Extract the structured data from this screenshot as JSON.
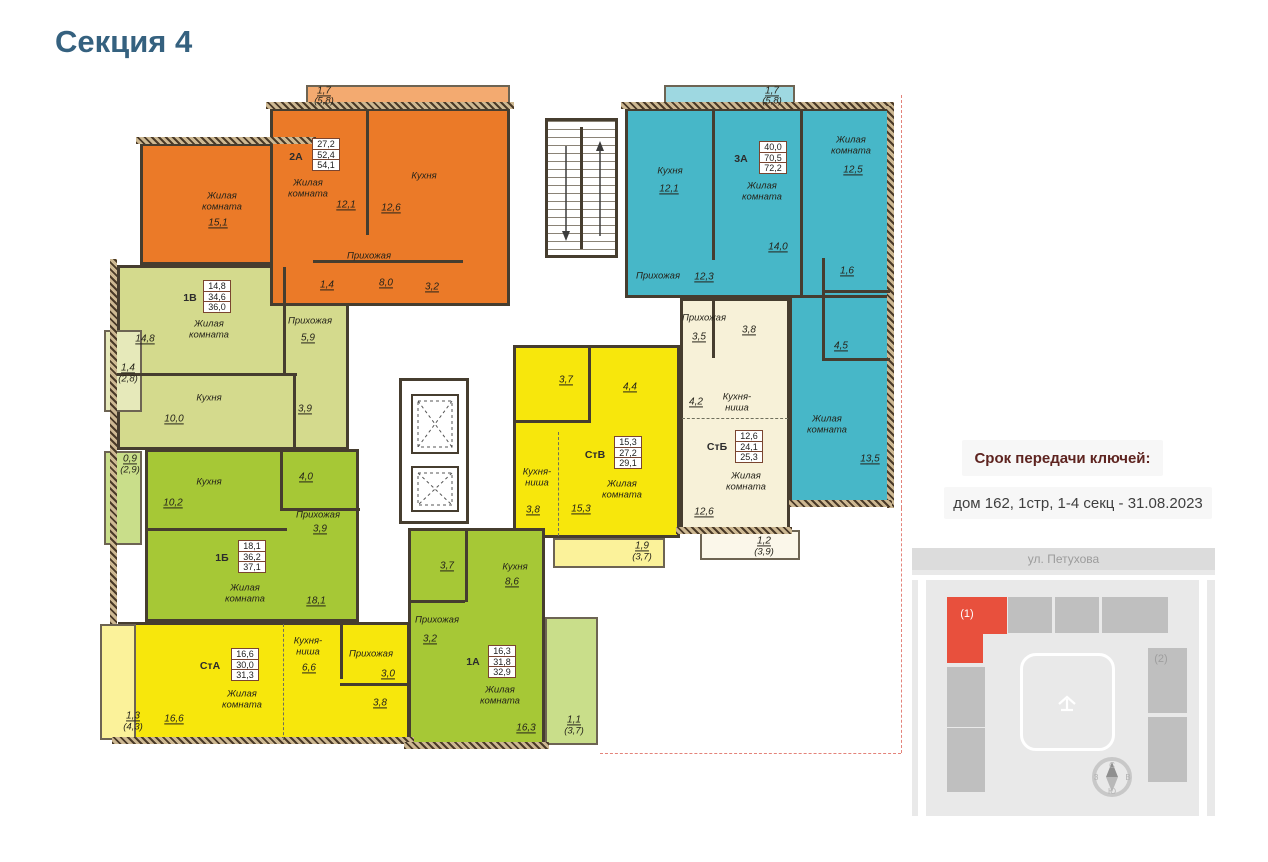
{
  "page": {
    "title": "Секция 4"
  },
  "sidebar": {
    "keys_title": "Срок передачи ключей:",
    "keys_info": "дом 162, 1стр, 1-4 секц - 31.08.2023"
  },
  "minimap": {
    "street": "ул. Петухова",
    "section1_label": "(1)",
    "section2_label": "(2)",
    "compass": {
      "n": "С",
      "e": "В",
      "s": "Ю",
      "w": "З"
    },
    "colors": {
      "highlight": "#e8503d",
      "block": "#bfbfbf",
      "card_bg": "#e9e9e9"
    }
  },
  "plan": {
    "colors": {
      "orange": "#eb7a28",
      "orange_light": "#f3aa70",
      "blue": "#47b7c8",
      "blue_light": "#9ed8e1",
      "green": "#a6c836",
      "green_light": "#c9de8a",
      "lightgreen": "#d4da8d",
      "lightgreen_light": "#e6e9ba",
      "yellow": "#f7e70c",
      "yellow_light": "#fbf29a",
      "cream": "#f7f1d8",
      "cream_light": "#fbf7ea",
      "wall": "#463d2f"
    },
    "apartments": [
      {
        "id": "1v",
        "label": "1В",
        "color": "lightgreen",
        "stats": [
          "14,8",
          "34,6",
          "36,0"
        ],
        "regions": [
          [
            117,
            265,
            232,
            185
          ]
        ],
        "label_xy": [
          190,
          298
        ],
        "table_xy": [
          203,
          281
        ],
        "balcony": {
          "rect": [
            104,
            330,
            38,
            82
          ],
          "color": "lightgreen_light"
        }
      },
      {
        "id": "1b",
        "label": "1Б",
        "color": "green",
        "stats": [
          "18,1",
          "36,2",
          "37,1"
        ],
        "regions": [
          [
            145,
            449,
            214,
            173
          ]
        ],
        "label_xy": [
          222,
          558
        ],
        "table_xy": [
          238,
          541
        ],
        "balcony": {
          "rect": [
            104,
            451,
            38,
            94
          ],
          "color": "green_light"
        }
      },
      {
        "id": "sta",
        "label": "СтА",
        "color": "yellow",
        "stats": [
          "16,6",
          "30,0",
          "31,3"
        ],
        "regions": [
          [
            118,
            622,
            292,
            120
          ]
        ],
        "label_xy": [
          210,
          666
        ],
        "table_xy": [
          231,
          649
        ],
        "balcony": {
          "rect": [
            100,
            624,
            36,
            116
          ],
          "color": "yellow_light"
        }
      },
      {
        "id": "2a",
        "label": "2А",
        "color": "orange",
        "stats": [
          "27,2",
          "52,4",
          "54,1"
        ],
        "regions": [
          [
            140,
            143,
            133,
            122
          ],
          [
            270,
            108,
            240,
            198
          ]
        ],
        "label_xy": [
          296,
          157
        ],
        "table_xy": [
          312,
          139
        ],
        "balcony": {
          "rect": [
            306,
            85,
            204,
            24
          ],
          "color": "orange_light"
        }
      },
      {
        "id": "3a",
        "label": "3А",
        "color": "blue",
        "stats": [
          "40,0",
          "70,5",
          "72,2"
        ],
        "regions": [
          [
            625,
            108,
            265,
            190
          ],
          [
            789,
            295,
            101,
            211
          ]
        ],
        "label_xy": [
          741,
          159
        ],
        "table_xy": [
          759,
          142
        ],
        "balcony": {
          "rect": [
            664,
            85,
            131,
            24
          ],
          "color": "blue_light"
        }
      },
      {
        "id": "stb",
        "label": "СтБ",
        "color": "cream",
        "stats": [
          "12,6",
          "24,1",
          "25,3"
        ],
        "regions": [
          [
            680,
            298,
            110,
            232
          ]
        ],
        "label_xy": [
          717,
          447
        ],
        "table_xy": [
          735,
          431
        ],
        "balcony": {
          "rect": [
            700,
            530,
            100,
            30
          ],
          "color": "cream_light"
        }
      },
      {
        "id": "stv",
        "label": "СтВ",
        "color": "yellow",
        "stats": [
          "15,3",
          "27,2",
          "29,1"
        ],
        "regions": [
          [
            513,
            345,
            167,
            193
          ]
        ],
        "label_xy": [
          595,
          455
        ],
        "table_xy": [
          614,
          437
        ],
        "balcony": {
          "rect": [
            553,
            538,
            112,
            30
          ],
          "color": "yellow_light"
        }
      },
      {
        "id": "1a",
        "label": "1А",
        "color": "green",
        "stats": [
          "16,3",
          "31,8",
          "32,9"
        ],
        "regions": [
          [
            408,
            528,
            137,
            217
          ]
        ],
        "label_xy": [
          473,
          662
        ],
        "table_xy": [
          488,
          646
        ],
        "balcony": {
          "rect": [
            545,
            617,
            53,
            128
          ],
          "color": "green_light"
        }
      }
    ],
    "texts": [
      {
        "t": "Жилая\nкомната",
        "x": 222,
        "y": 202,
        "k": "n"
      },
      {
        "t": "15,1",
        "x": 218,
        "y": 223,
        "k": "v"
      },
      {
        "t": "Жилая\nкомната",
        "x": 308,
        "y": 189,
        "k": "n"
      },
      {
        "t": "12,1",
        "x": 346,
        "y": 205,
        "k": "v"
      },
      {
        "t": "Кухня",
        "x": 424,
        "y": 177,
        "k": "n"
      },
      {
        "t": "12,6",
        "x": 391,
        "y": 208,
        "k": "v"
      },
      {
        "t": "Прихожая",
        "x": 369,
        "y": 257,
        "k": "n"
      },
      {
        "t": "8,0",
        "x": 386,
        "y": 283,
        "k": "v"
      },
      {
        "t": "1,4",
        "x": 327,
        "y": 285,
        "k": "v"
      },
      {
        "t": "3,2",
        "x": 432,
        "y": 287,
        "k": "v"
      },
      {
        "t": "1,7",
        "x": 324,
        "y": 91,
        "k": "v"
      },
      {
        "t": "(5,8)",
        "x": 324,
        "y": 102,
        "k": "b"
      },
      {
        "t": "Кухня",
        "x": 670,
        "y": 172,
        "k": "n"
      },
      {
        "t": "12,1",
        "x": 669,
        "y": 189,
        "k": "v"
      },
      {
        "t": "Жилая\nкомната",
        "x": 762,
        "y": 192,
        "k": "n"
      },
      {
        "t": "14,0",
        "x": 778,
        "y": 247,
        "k": "v"
      },
      {
        "t": "Жилая\nкомната",
        "x": 851,
        "y": 146,
        "k": "n"
      },
      {
        "t": "12,5",
        "x": 853,
        "y": 170,
        "k": "v"
      },
      {
        "t": "Прихожая",
        "x": 658,
        "y": 277,
        "k": "n"
      },
      {
        "t": "12,3",
        "x": 704,
        "y": 277,
        "k": "v"
      },
      {
        "t": "1,6",
        "x": 847,
        "y": 271,
        "k": "v"
      },
      {
        "t": "4,5",
        "x": 841,
        "y": 346,
        "k": "v"
      },
      {
        "t": "Жилая\nкомната",
        "x": 827,
        "y": 425,
        "k": "n"
      },
      {
        "t": "13,5",
        "x": 870,
        "y": 459,
        "k": "v"
      },
      {
        "t": "1,7",
        "x": 772,
        "y": 91,
        "k": "v"
      },
      {
        "t": "(5,8)",
        "x": 772,
        "y": 102,
        "k": "b"
      },
      {
        "t": "Жилая\nкомната",
        "x": 209,
        "y": 330,
        "k": "n"
      },
      {
        "t": "14,8",
        "x": 145,
        "y": 339,
        "k": "v"
      },
      {
        "t": "Прихожая",
        "x": 310,
        "y": 322,
        "k": "n"
      },
      {
        "t": "5,9",
        "x": 308,
        "y": 338,
        "k": "v"
      },
      {
        "t": "Кухня",
        "x": 209,
        "y": 399,
        "k": "n"
      },
      {
        "t": "10,0",
        "x": 174,
        "y": 419,
        "k": "v"
      },
      {
        "t": "3,9",
        "x": 305,
        "y": 409,
        "k": "v"
      },
      {
        "t": "1,4",
        "x": 128,
        "y": 368,
        "k": "v"
      },
      {
        "t": "(2,8)",
        "x": 128,
        "y": 380,
        "k": "b"
      },
      {
        "t": "Кухня",
        "x": 209,
        "y": 483,
        "k": "n"
      },
      {
        "t": "10,2",
        "x": 173,
        "y": 503,
        "k": "v"
      },
      {
        "t": "4,0",
        "x": 306,
        "y": 477,
        "k": "v"
      },
      {
        "t": "Прихожая",
        "x": 318,
        "y": 516,
        "k": "n"
      },
      {
        "t": "3,9",
        "x": 320,
        "y": 529,
        "k": "v"
      },
      {
        "t": "Жилая\nкомната",
        "x": 245,
        "y": 594,
        "k": "n"
      },
      {
        "t": "18,1",
        "x": 316,
        "y": 601,
        "k": "v"
      },
      {
        "t": "0,9",
        "x": 130,
        "y": 459,
        "k": "v"
      },
      {
        "t": "(2,9)",
        "x": 130,
        "y": 471,
        "k": "b"
      },
      {
        "t": "Жилая\nкомната",
        "x": 242,
        "y": 700,
        "k": "n"
      },
      {
        "t": "16,6",
        "x": 174,
        "y": 719,
        "k": "v"
      },
      {
        "t": "Кухня-\nниша",
        "x": 308,
        "y": 647,
        "k": "n"
      },
      {
        "t": "6,6",
        "x": 309,
        "y": 668,
        "k": "v"
      },
      {
        "t": "Прихожая",
        "x": 371,
        "y": 655,
        "k": "n"
      },
      {
        "t": "3,0",
        "x": 388,
        "y": 674,
        "k": "v"
      },
      {
        "t": "3,8",
        "x": 380,
        "y": 703,
        "k": "v"
      },
      {
        "t": "1,3",
        "x": 133,
        "y": 716,
        "k": "v"
      },
      {
        "t": "(4,3)",
        "x": 133,
        "y": 728,
        "k": "b"
      },
      {
        "t": "3,7",
        "x": 447,
        "y": 566,
        "k": "v"
      },
      {
        "t": "Кухня",
        "x": 515,
        "y": 568,
        "k": "n"
      },
      {
        "t": "8,6",
        "x": 512,
        "y": 582,
        "k": "v"
      },
      {
        "t": "Прихожая",
        "x": 437,
        "y": 621,
        "k": "n"
      },
      {
        "t": "3,2",
        "x": 430,
        "y": 639,
        "k": "v"
      },
      {
        "t": "Жилая\nкомната",
        "x": 500,
        "y": 696,
        "k": "n"
      },
      {
        "t": "16,3",
        "x": 526,
        "y": 728,
        "k": "v"
      },
      {
        "t": "1,1",
        "x": 574,
        "y": 720,
        "k": "v"
      },
      {
        "t": "(3,7)",
        "x": 574,
        "y": 732,
        "k": "b"
      },
      {
        "t": "3,7",
        "x": 566,
        "y": 380,
        "k": "v"
      },
      {
        "t": "4,4",
        "x": 630,
        "y": 387,
        "k": "v"
      },
      {
        "t": "Кухня-\nниша",
        "x": 537,
        "y": 478,
        "k": "n"
      },
      {
        "t": "3,8",
        "x": 533,
        "y": 510,
        "k": "v"
      },
      {
        "t": "15,3",
        "x": 581,
        "y": 509,
        "k": "v"
      },
      {
        "t": "Жилая\nкомната",
        "x": 622,
        "y": 490,
        "k": "n"
      },
      {
        "t": "1,9",
        "x": 642,
        "y": 546,
        "k": "v"
      },
      {
        "t": "(3,7)",
        "x": 642,
        "y": 558,
        "k": "b"
      },
      {
        "t": "Прихожая",
        "x": 704,
        "y": 319,
        "k": "n"
      },
      {
        "t": "3,5",
        "x": 699,
        "y": 337,
        "k": "v"
      },
      {
        "t": "3,8",
        "x": 749,
        "y": 330,
        "k": "v"
      },
      {
        "t": "4,2",
        "x": 696,
        "y": 402,
        "k": "v"
      },
      {
        "t": "Кухня-\nниша",
        "x": 737,
        "y": 403,
        "k": "n"
      },
      {
        "t": "Жилая\nкомната",
        "x": 746,
        "y": 482,
        "k": "n"
      },
      {
        "t": "12,6",
        "x": 704,
        "y": 512,
        "k": "v"
      },
      {
        "t": "1,2",
        "x": 764,
        "y": 541,
        "k": "v"
      },
      {
        "t": "(3,9)",
        "x": 764,
        "y": 553,
        "k": "b"
      }
    ]
  }
}
